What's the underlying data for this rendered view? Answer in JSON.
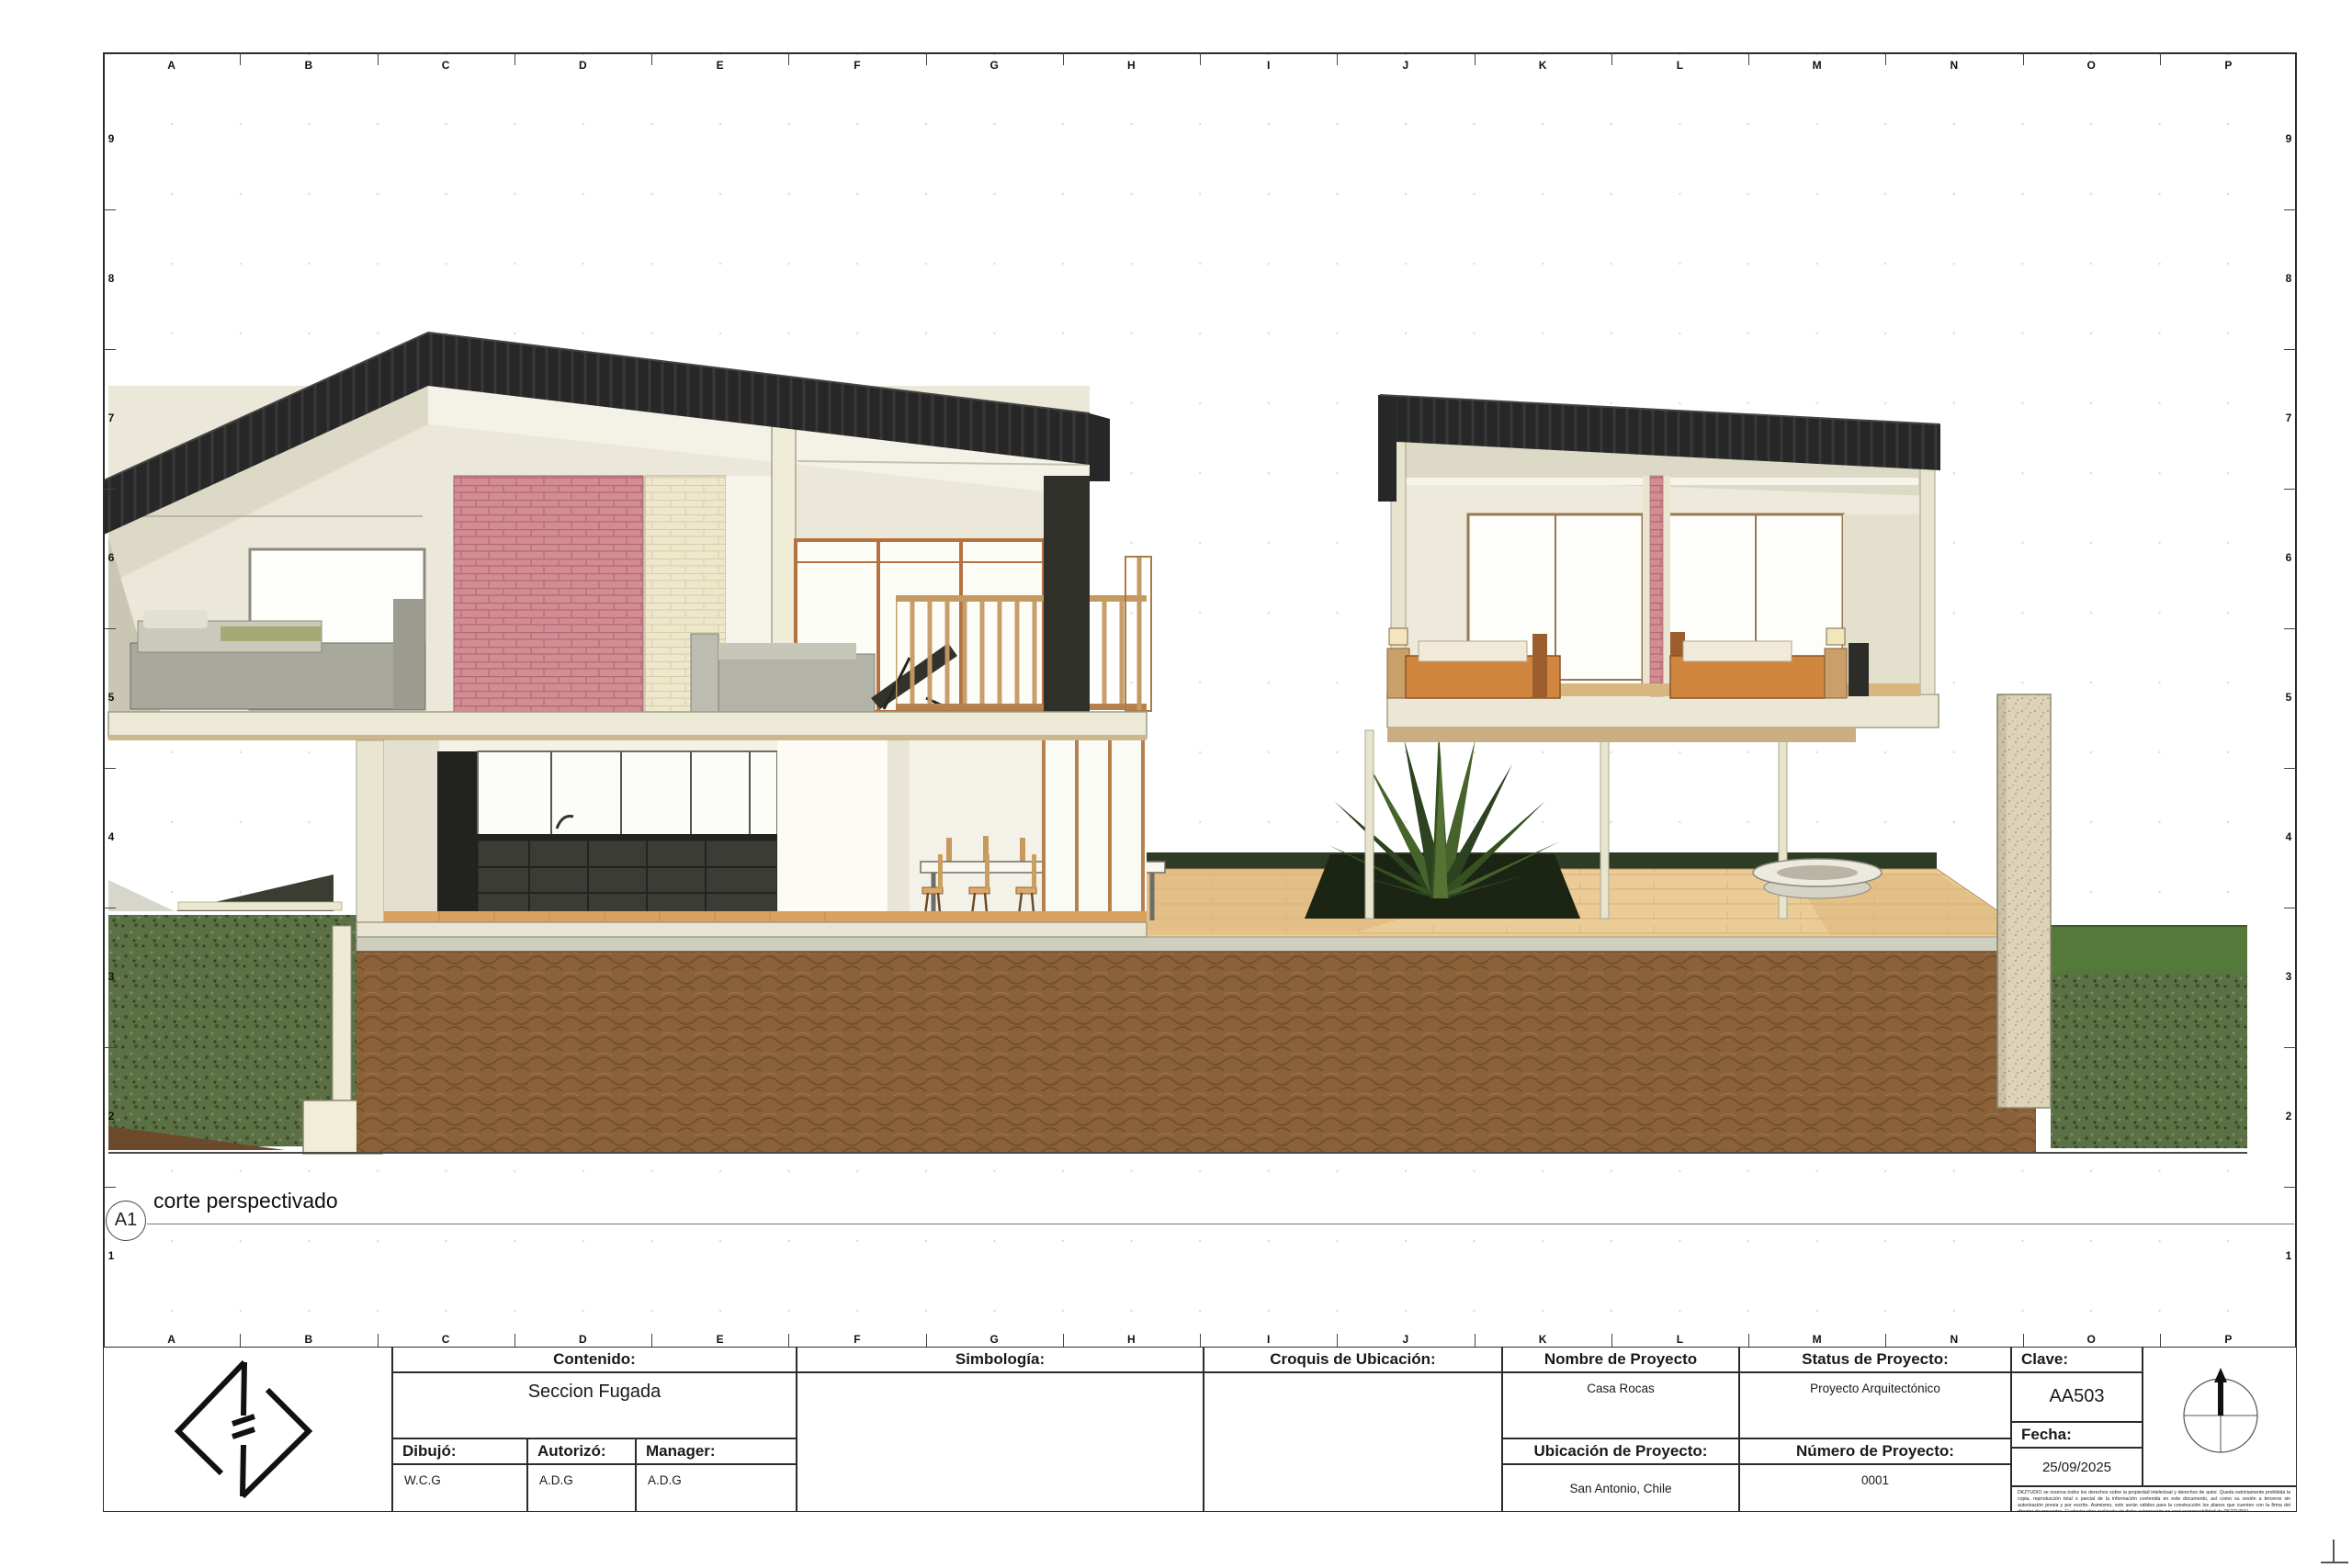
{
  "view": {
    "tag": "A1",
    "title": "corte perspectivado"
  },
  "grid": {
    "columns": [
      "A",
      "B",
      "C",
      "D",
      "E",
      "F",
      "G",
      "H",
      "I",
      "J",
      "K",
      "L",
      "M",
      "N",
      "O",
      "P"
    ],
    "rows": [
      "9",
      "8",
      "7",
      "6",
      "5",
      "4",
      "3",
      "2",
      "1"
    ]
  },
  "title_block": {
    "contenido": {
      "label": "Contenido:",
      "value": "Seccion Fugada"
    },
    "dibujo": {
      "label": "Dibujó:",
      "value": "W.C.G"
    },
    "autorizo": {
      "label": "Autorizó:",
      "value": "A.D.G"
    },
    "manager": {
      "label": "Manager:",
      "value": "A.D.G"
    },
    "simbologia": {
      "label": "Simbología:"
    },
    "croquis": {
      "label": "Croquis de Ubicación:"
    },
    "nombre": {
      "label": "Nombre de Proyecto",
      "value": "Casa Rocas"
    },
    "status": {
      "label": "Status de Proyecto:",
      "value": "Proyecto Arquitectónico"
    },
    "clave": {
      "label": "Clave:",
      "value": "AA503"
    },
    "ubicacion": {
      "label": "Ubicación de Proyecto:",
      "value": "San Antonio, Chile"
    },
    "numero": {
      "label": "Número de Proyecto:",
      "value": "0001"
    },
    "fecha": {
      "label": "Fecha:",
      "value": "25/09/2025"
    },
    "disclaimer": "DKZTUDIO se reserva todos los derechos sobre la propiedad intelectual y derechos de autor. Queda estrictamente prohibida la copia, reproducción total o parcial de la información contenida en este documento, así como su cesión a terceros sin autorización previa y por escrito. Asimismo, solo serán válidos para la construcción los planos que cuenten con la firma del director de proyectos. Cualquier obra realizada sin dicha autorización no será responsabilidad de DKZTUDIO."
  },
  "colors": {
    "paper": "#ffffff",
    "line": "#2b2b2b",
    "roof-dark": "#272727",
    "wall-cream": "#ebe8d9",
    "slab-cream": "#ece9d6",
    "brick-pink": "#d28c92",
    "stone-cream": "#ede7cc",
    "earth-brown": "#8a6138",
    "grass-green": "#5c7045",
    "lawn-green": "#54793a",
    "deck-tan": "#eccc96",
    "wood-floor": "#d8a15f",
    "frame-orange": "#b5713f",
    "kitchen-dark": "#3c3c37",
    "concrete": "#cfcfc0"
  }
}
